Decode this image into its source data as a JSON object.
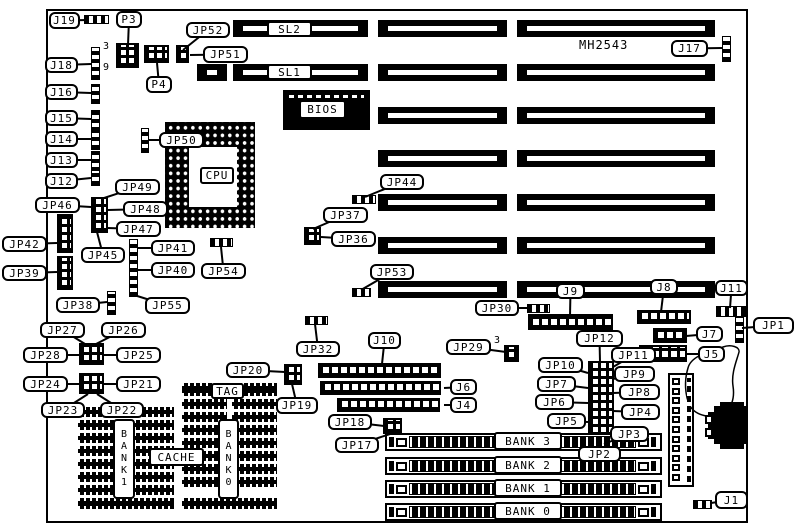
{
  "diagram_title": "MH2543 motherboard jumper and connector location diagram",
  "texts": [
    {
      "t": "MH2543",
      "n": "board-id-text",
      "x": 579,
      "y": 38,
      "fs": 12
    },
    {
      "t": "3",
      "n": "p3-pin3-number",
      "x": 103,
      "y": 41,
      "fs": 10
    },
    {
      "t": "9",
      "n": "p3-pin9-number",
      "x": 103,
      "y": 62,
      "fs": 10
    },
    {
      "t": "3",
      "n": "jp29-pin3-number",
      "x": 494,
      "y": 335,
      "fs": 10
    }
  ],
  "callouts": [
    {
      "t": "J19",
      "x": 49,
      "y": 12,
      "w": 31,
      "h": 17,
      "ax": 88,
      "ay": 20
    },
    {
      "t": "P3",
      "x": 116,
      "y": 11,
      "w": 26,
      "h": 17,
      "ax": 128,
      "ay": 45
    },
    {
      "t": "JP52",
      "x": 186,
      "y": 22,
      "w": 44,
      "h": 16,
      "ax": 183,
      "ay": 50
    },
    {
      "t": "JP51",
      "x": 203,
      "y": 46,
      "w": 45,
      "h": 17,
      "ax": 190,
      "ay": 55
    },
    {
      "t": "J18",
      "x": 45,
      "y": 57,
      "w": 33,
      "h": 16,
      "ax": 91,
      "ay": 64
    },
    {
      "t": "J16",
      "x": 45,
      "y": 84,
      "w": 33,
      "h": 16,
      "ax": 91,
      "ay": 93
    },
    {
      "t": "J15",
      "x": 45,
      "y": 110,
      "w": 33,
      "h": 16,
      "ax": 91,
      "ay": 119
    },
    {
      "t": "J14",
      "x": 45,
      "y": 131,
      "w": 33,
      "h": 16,
      "ax": 91,
      "ay": 139
    },
    {
      "t": "J13",
      "x": 45,
      "y": 152,
      "w": 33,
      "h": 16,
      "ax": 91,
      "ay": 160
    },
    {
      "t": "J12",
      "x": 45,
      "y": 173,
      "w": 33,
      "h": 16,
      "ax": 91,
      "ay": 178
    },
    {
      "t": "P4",
      "x": 146,
      "y": 76,
      "w": 26,
      "h": 17,
      "ax": 157,
      "ay": 63
    },
    {
      "t": "JP50",
      "x": 159,
      "y": 132,
      "w": 45,
      "h": 16,
      "ax": 148,
      "ay": 140
    },
    {
      "t": "JP49",
      "x": 115,
      "y": 179,
      "w": 45,
      "h": 16,
      "ax": 101,
      "ay": 199
    },
    {
      "t": "JP46",
      "x": 35,
      "y": 197,
      "w": 45,
      "h": 16,
      "ax": 91,
      "ay": 207
    },
    {
      "t": "JP48",
      "x": 123,
      "y": 201,
      "w": 45,
      "h": 16,
      "ax": 108,
      "ay": 210
    },
    {
      "t": "JP47",
      "x": 116,
      "y": 221,
      "w": 45,
      "h": 16,
      "ax": 107,
      "ay": 228
    },
    {
      "t": "JP45",
      "x": 81,
      "y": 247,
      "w": 44,
      "h": 16,
      "ax": 97,
      "ay": 232
    },
    {
      "t": "JP42",
      "x": 2,
      "y": 236,
      "w": 45,
      "h": 16,
      "ax": 57,
      "ay": 243
    },
    {
      "t": "JP39",
      "x": 2,
      "y": 265,
      "w": 45,
      "h": 16,
      "ax": 57,
      "ay": 272
    },
    {
      "t": "JP41",
      "x": 151,
      "y": 240,
      "w": 44,
      "h": 16,
      "ax": 138,
      "ay": 248
    },
    {
      "t": "JP40",
      "x": 151,
      "y": 262,
      "w": 44,
      "h": 16,
      "ax": 138,
      "ay": 270
    },
    {
      "t": "JP55",
      "x": 145,
      "y": 297,
      "w": 45,
      "h": 17,
      "ax": 134,
      "ay": 295
    },
    {
      "t": "JP54",
      "x": 201,
      "y": 263,
      "w": 45,
      "h": 16,
      "ax": 221,
      "ay": 247
    },
    {
      "t": "JP38",
      "x": 56,
      "y": 297,
      "w": 44,
      "h": 16,
      "ax": 107,
      "ay": 302
    },
    {
      "t": "JP37",
      "x": 323,
      "y": 207,
      "w": 45,
      "h": 16,
      "ax": 313,
      "ay": 229
    },
    {
      "t": "JP36",
      "x": 331,
      "y": 231,
      "w": 45,
      "h": 16,
      "ax": 321,
      "ay": 237
    },
    {
      "t": "JP44",
      "x": 380,
      "y": 174,
      "w": 44,
      "h": 16,
      "ax": 365,
      "ay": 197
    },
    {
      "t": "JP53",
      "x": 370,
      "y": 264,
      "w": 44,
      "h": 16,
      "ax": 361,
      "ay": 290
    },
    {
      "t": "JP30",
      "x": 475,
      "y": 300,
      "w": 44,
      "h": 16,
      "ax": 527,
      "ay": 308
    },
    {
      "t": "J9",
      "x": 556,
      "y": 283,
      "w": 29,
      "h": 16,
      "ax": 570,
      "ay": 316
    },
    {
      "t": "J8",
      "x": 650,
      "y": 279,
      "w": 28,
      "h": 16,
      "ax": 661,
      "ay": 312
    },
    {
      "t": "J11",
      "x": 715,
      "y": 280,
      "w": 33,
      "h": 16,
      "ax": 730,
      "ay": 308
    },
    {
      "t": "J17",
      "x": 671,
      "y": 40,
      "w": 37,
      "h": 17,
      "ax": 722,
      "ay": 48
    },
    {
      "t": "JP1",
      "x": 753,
      "y": 317,
      "w": 41,
      "h": 17,
      "ax": 742,
      "ay": 328
    },
    {
      "t": "J7",
      "x": 696,
      "y": 326,
      "w": 27,
      "h": 16,
      "ax": 686,
      "ay": 336
    },
    {
      "t": "J5",
      "x": 698,
      "y": 346,
      "w": 27,
      "h": 16,
      "ax": 686,
      "ay": 354
    },
    {
      "t": "JP32",
      "x": 296,
      "y": 341,
      "w": 44,
      "h": 16,
      "ax": 315,
      "ay": 324
    },
    {
      "t": "J10",
      "x": 368,
      "y": 332,
      "w": 33,
      "h": 17,
      "ax": 382,
      "ay": 364
    },
    {
      "t": "JP29",
      "x": 446,
      "y": 339,
      "w": 45,
      "h": 16,
      "ax": 506,
      "ay": 352
    },
    {
      "t": "J6",
      "x": 450,
      "y": 379,
      "w": 27,
      "h": 16,
      "ax": 444,
      "ay": 388
    },
    {
      "t": "J4",
      "x": 450,
      "y": 397,
      "w": 27,
      "h": 16,
      "ax": 444,
      "ay": 405
    },
    {
      "t": "JP20",
      "x": 226,
      "y": 362,
      "w": 44,
      "h": 16,
      "ax": 285,
      "ay": 372
    },
    {
      "t": "JP19",
      "x": 276,
      "y": 397,
      "w": 42,
      "h": 17,
      "ax": 292,
      "ay": 384
    },
    {
      "t": "JP18",
      "x": 328,
      "y": 414,
      "w": 44,
      "h": 16,
      "ax": 384,
      "ay": 426
    },
    {
      "t": "JP17",
      "x": 335,
      "y": 437,
      "w": 44,
      "h": 16,
      "ax": 390,
      "ay": 434
    },
    {
      "t": "JP27",
      "x": 40,
      "y": 322,
      "w": 45,
      "h": 16,
      "ax": 85,
      "ay": 344
    },
    {
      "t": "JP26",
      "x": 101,
      "y": 322,
      "w": 45,
      "h": 16,
      "ax": 96,
      "ay": 344
    },
    {
      "t": "JP28",
      "x": 23,
      "y": 347,
      "w": 45,
      "h": 16,
      "ax": 79,
      "ay": 355
    },
    {
      "t": "JP25",
      "x": 116,
      "y": 347,
      "w": 45,
      "h": 16,
      "ax": 104,
      "ay": 355
    },
    {
      "t": "JP24",
      "x": 23,
      "y": 376,
      "w": 45,
      "h": 16,
      "ax": 79,
      "ay": 384
    },
    {
      "t": "JP21",
      "x": 116,
      "y": 376,
      "w": 45,
      "h": 16,
      "ax": 104,
      "ay": 384
    },
    {
      "t": "JP23",
      "x": 41,
      "y": 402,
      "w": 44,
      "h": 16,
      "ax": 88,
      "ay": 394
    },
    {
      "t": "JP22",
      "x": 100,
      "y": 402,
      "w": 44,
      "h": 16,
      "ax": 97,
      "ay": 394
    },
    {
      "t": "JP12",
      "x": 576,
      "y": 330,
      "w": 47,
      "h": 17,
      "ax": 600,
      "ay": 362
    },
    {
      "t": "JP11",
      "x": 611,
      "y": 347,
      "w": 45,
      "h": 16,
      "ax": 613,
      "ay": 367
    },
    {
      "t": "JP10",
      "x": 538,
      "y": 357,
      "w": 45,
      "h": 16,
      "ax": 588,
      "ay": 373
    },
    {
      "t": "JP9",
      "x": 614,
      "y": 366,
      "w": 41,
      "h": 16,
      "ax": 613,
      "ay": 379
    },
    {
      "t": "JP7",
      "x": 537,
      "y": 376,
      "w": 39,
      "h": 16,
      "ax": 588,
      "ay": 388
    },
    {
      "t": "JP8",
      "x": 619,
      "y": 384,
      "w": 41,
      "h": 16,
      "ax": 613,
      "ay": 393
    },
    {
      "t": "JP6",
      "x": 535,
      "y": 394,
      "w": 39,
      "h": 16,
      "ax": 588,
      "ay": 403
    },
    {
      "t": "JP4",
      "x": 621,
      "y": 404,
      "w": 39,
      "h": 16,
      "ax": 613,
      "ay": 411
    },
    {
      "t": "JP5",
      "x": 547,
      "y": 413,
      "w": 39,
      "h": 16,
      "ax": 588,
      "ay": 422
    },
    {
      "t": "JP3",
      "x": 610,
      "y": 426,
      "w": 39,
      "h": 16,
      "ax": 604,
      "ay": 444
    },
    {
      "t": "JP2",
      "x": 578,
      "y": 446,
      "w": 43,
      "h": 16,
      "ax": 599,
      "ay": 444
    },
    {
      "t": "J1",
      "x": 715,
      "y": 491,
      "w": 33,
      "h": 18,
      "ax": 711,
      "ay": 503
    }
  ],
  "plates": [
    {
      "t": "SL2",
      "x": 267,
      "y": 21,
      "w": 45,
      "h": 16
    },
    {
      "t": "SL1",
      "x": 267,
      "y": 64,
      "w": 45,
      "h": 16
    },
    {
      "t": "BIOS",
      "x": 299,
      "y": 100,
      "w": 47,
      "h": 19
    },
    {
      "t": "CPU",
      "x": 200,
      "y": 167,
      "w": 34,
      "h": 17
    },
    {
      "t": "TAG",
      "x": 211,
      "y": 383,
      "w": 33,
      "h": 16
    },
    {
      "t": "CACHE",
      "x": 149,
      "y": 448,
      "w": 55,
      "h": 18
    },
    {
      "t": "BANK 3",
      "x": 494,
      "y": 432,
      "w": 68,
      "h": 18
    },
    {
      "t": "BANK 2",
      "x": 494,
      "y": 456,
      "w": 68,
      "h": 18
    },
    {
      "t": "BANK 1",
      "x": 494,
      "y": 479,
      "w": 68,
      "h": 18
    },
    {
      "t": "BANK 0",
      "x": 494,
      "y": 502,
      "w": 68,
      "h": 18
    }
  ],
  "vplates": [
    {
      "t": "BANK1",
      "x": 113,
      "y": 419,
      "w": 22,
      "h": 80
    },
    {
      "t": "BANK0",
      "x": 218,
      "y": 419,
      "w": 21,
      "h": 80
    }
  ]
}
